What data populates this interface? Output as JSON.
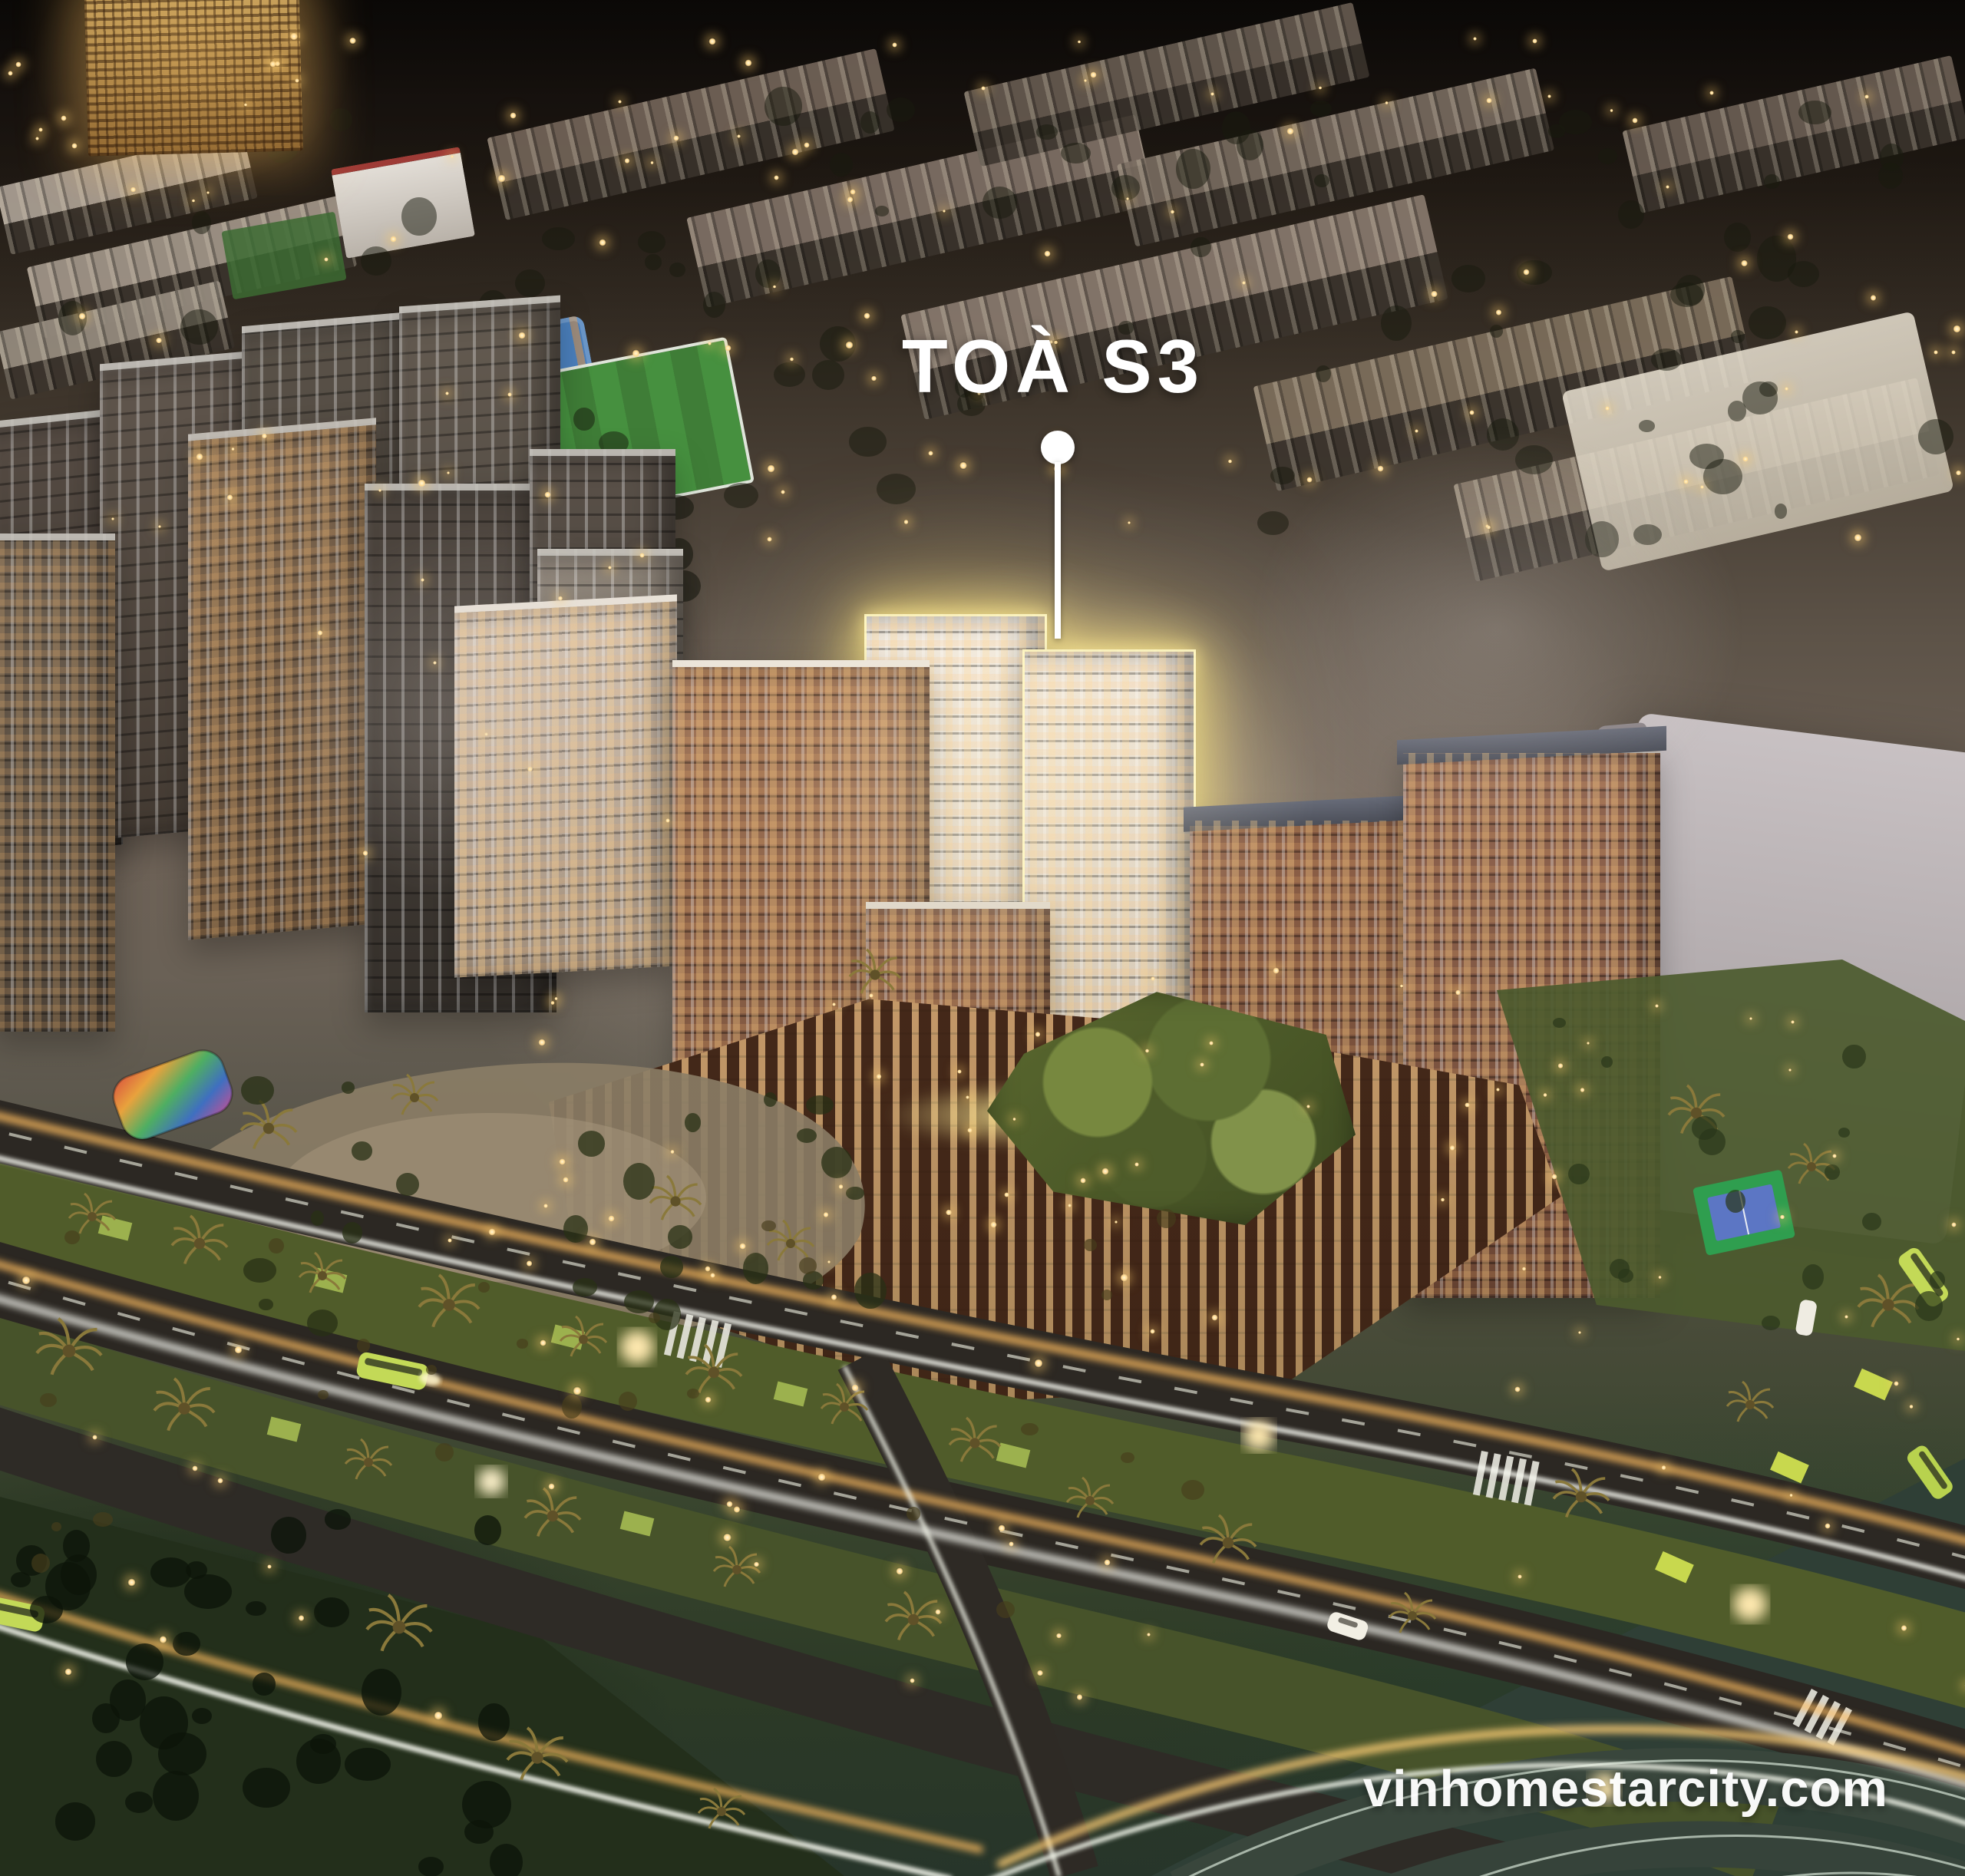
{
  "callout": {
    "label": "TOÀ S3"
  },
  "watermark": {
    "text": "vinhomestarcity.com"
  },
  "palette": {
    "highlight_glow": "#ffe98f",
    "label_text": "#ffffff",
    "watermark_text": "#ffffff",
    "street_light": "#ffd98f",
    "light_trail_amber": "#ffbe62",
    "light_trail_white": "#f6f7ef",
    "dusk_sky": "#181310",
    "brick_facade": "#8a5f49",
    "cream_facade": "#f0e7db",
    "lawn_green": "#55622c",
    "park_dark_green": "#1f2c19",
    "asphalt": "#2b2722",
    "gray_building": "#b7b0b2",
    "golden_tower": "#c89a52",
    "court_green": "#2f9e4f",
    "court_blue": "#5c76c4",
    "bus_green": "#c3d957"
  }
}
